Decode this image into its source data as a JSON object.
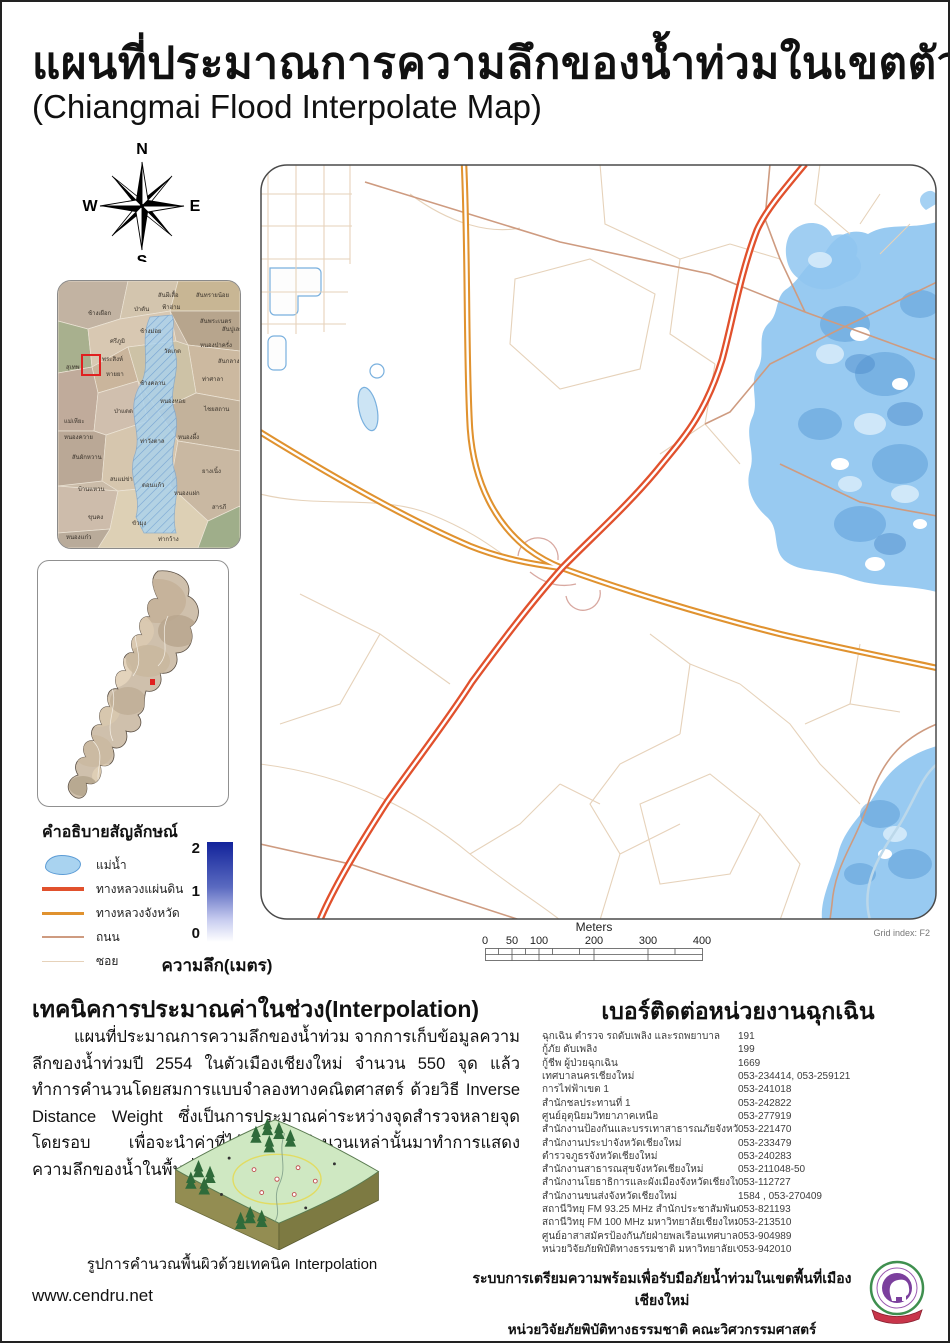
{
  "poster": {
    "title_th": "แผนที่ประมาณการความลึกของน้ำท่วมในเขตตัวเมืองเชียงใหม่",
    "title_en": "(Chiangmai Flood Interpolate Map)"
  },
  "colors": {
    "national": "#E1512D",
    "provincial": "#E0922F",
    "road": "#CE9B80",
    "alley": "#E6D2BA",
    "river_fill": "#A9D3F0",
    "river_stroke": "#5B9BD5",
    "flood": "#8FC6F0",
    "flood_dark": "#5E9FD8",
    "flood_pale": "#D6EBFA",
    "highlight": "#E02020"
  },
  "compass": {
    "n": "N",
    "s": "S",
    "e": "E",
    "w": "W"
  },
  "legend": {
    "title": "คำอธิบายสัญลักษณ์",
    "items": [
      {
        "label": "แม่น้ำ",
        "swatch": "river"
      },
      {
        "label": "ทางหลวงแผ่นดิน",
        "swatch": "national"
      },
      {
        "label": "ทางหลวงจังหวัด",
        "swatch": "provincial"
      },
      {
        "label": "ถนน",
        "swatch": "road"
      },
      {
        "label": "ซอย",
        "swatch": "alley"
      }
    ],
    "ramp": {
      "ticks": [
        "2",
        "1",
        "0"
      ],
      "caption": "ความลึก(เมตร)"
    }
  },
  "scalebar": {
    "unit_label": "Meters",
    "ticks": [
      "0",
      "50",
      "100",
      "200",
      "300",
      "400"
    ]
  },
  "grid_index": "Grid index: F2",
  "inset_city": {
    "labels": [
      {
        "t": "ช้างเผือก",
        "x": 30,
        "y": 34
      },
      {
        "t": "ป่าตัน",
        "x": 76,
        "y": 30
      },
      {
        "t": "สันผีเสื้อ",
        "x": 100,
        "y": 16
      },
      {
        "t": "ฟ้าฮ่าม",
        "x": 104,
        "y": 28
      },
      {
        "t": "สันทรายน้อย",
        "x": 138,
        "y": 16
      },
      {
        "t": "สันพระเนตร",
        "x": 142,
        "y": 42
      },
      {
        "t": "สันปูเลย",
        "x": 164,
        "y": 50
      },
      {
        "t": "ช้างม่อย",
        "x": 82,
        "y": 52
      },
      {
        "t": "ศรีภูมิ",
        "x": 52,
        "y": 62
      },
      {
        "t": "หนองป่าครั่ง",
        "x": 142,
        "y": 66
      },
      {
        "t": "วัดเกต",
        "x": 106,
        "y": 72
      },
      {
        "t": "พระสิงห์",
        "x": 44,
        "y": 80
      },
      {
        "t": "สุเทพ",
        "x": 8,
        "y": 88
      },
      {
        "t": "สันกลาง",
        "x": 160,
        "y": 82
      },
      {
        "t": "หายยา",
        "x": 48,
        "y": 95
      },
      {
        "t": "ช้างคลาน",
        "x": 82,
        "y": 104
      },
      {
        "t": "ท่าศาลา",
        "x": 144,
        "y": 100
      },
      {
        "t": "หนองหอย",
        "x": 102,
        "y": 122
      },
      {
        "t": "ไชยสถาน",
        "x": 146,
        "y": 130
      },
      {
        "t": "ป่าแดด",
        "x": 56,
        "y": 132
      },
      {
        "t": "แม่เหียะ",
        "x": 6,
        "y": 142
      },
      {
        "t": "หนองควาย",
        "x": 6,
        "y": 158
      },
      {
        "t": "สันผักหวาน",
        "x": 14,
        "y": 178
      },
      {
        "t": "ท่าวังตาล",
        "x": 82,
        "y": 162
      },
      {
        "t": "หนองผึ้ง",
        "x": 120,
        "y": 158
      },
      {
        "t": "บ้านแหวน",
        "x": 20,
        "y": 210
      },
      {
        "t": "สบแม่ข่า",
        "x": 52,
        "y": 200
      },
      {
        "t": "ดอนแก้ว",
        "x": 84,
        "y": 206
      },
      {
        "t": "หนองแฝก",
        "x": 116,
        "y": 214
      },
      {
        "t": "ยางเนิ้ง",
        "x": 144,
        "y": 192
      },
      {
        "t": "สารภี",
        "x": 154,
        "y": 228
      },
      {
        "t": "ขุนคง",
        "x": 30,
        "y": 238
      },
      {
        "t": "ขัวมุง",
        "x": 74,
        "y": 244
      },
      {
        "t": "ท่ากว้าง",
        "x": 100,
        "y": 260
      },
      {
        "t": "หนองแก๋ว",
        "x": 8,
        "y": 258
      }
    ]
  },
  "interpolation": {
    "heading": "เทคนิคการประมาณค่าในช่วง(Interpolation)",
    "body": "แผนที่ประมาณการความลึกของน้ำท่วม จากการเก็บข้อมูลความลึกของน้ำท่วมปี 2554 ในตัวเมืองเชียงใหม่ จำนวน 550 จุด แล้วทำการคำนวนโดยสมการแบบจำลองทางคณิตศาสตร์ ด้วยวิธี Inverse Distance Weight ซึ่งเป็นการประมาณค่าระหว่างจุดสำรวจหลายจุดโดยรอบ เพื่อจะนำค่าที่ได้จากการคำนวนเหล่านั้นมาทำการแสดงความลึกของน้ำในพื้นที่เสี่ยงภัยน้ำท่วม",
    "figure_caption": "รูปการคำนวณพื้นผิวด้วยเทคนิค Interpolation"
  },
  "contacts": {
    "heading": "เบอร์ติดต่อหน่วยงานฉุกเฉิน",
    "rows": [
      [
        "ฉุกเฉิน ตำรวจ รถดับเพลิง และรถพยาบาล",
        "191"
      ],
      [
        "กู้ภัย ดับเพลิง",
        "199"
      ],
      [
        "กู้ชีพ ผู้ป่วยฉุกเฉิน",
        "1669"
      ],
      [
        "เทศบาลนครเชียงใหม่",
        "053-234414, 053-259121"
      ],
      [
        "การไฟฟ้าเขต 1",
        "053-241018"
      ],
      [
        "สำนักชลประทานที่ 1",
        "053-242822"
      ],
      [
        "ศูนย์อุตุนิยมวิทยาภาคเหนือ",
        "053-277919"
      ],
      [
        "สำนักงานป้องกันและบรรเทาสาธารณภัยจังหวัดเชียงใหม่",
        "053-221470"
      ],
      [
        "สำนักงานประปาจังหวัดเชียงใหม่",
        "053-233479"
      ],
      [
        "ตำรวจภูธรจังหวัดเชียงใหม่",
        "053-240283"
      ],
      [
        "สำนักงานสาธารณสุขจังหวัดเชียงใหม่",
        "053-211048-50"
      ],
      [
        "สำนักงานโยธาธิการและผังเมืองจังหวัดเชียงใหม่",
        "053-112727"
      ],
      [
        "สำนักงานขนส่งจังหวัดเชียงใหม่",
        "1584 , 053-270409"
      ],
      [
        "สถานีวิทยุ FM 93.25 MHz  สำนักประชาสัมพันธ์ เขต 3",
        "053-821193"
      ],
      [
        "สถานีวิทยุ FM 100 MHz  มหาวิทยาลัยเชียงใหม่",
        "053-213510"
      ],
      [
        "ศูนย์อาสาสมัครป้องกันภัยฝ่ายพลเรือนเทศบาลนครเชียงใหม่",
        "053-904989"
      ],
      [
        "หน่วยวิจัยภัยพิบัติทางธรรมชาติ มหาวิทยาลัยเชียงใหม่",
        "053-942010"
      ]
    ]
  },
  "footer": {
    "website": "www.cendru.net",
    "line1": "ระบบการเตรียมความพร้อมเพื่อรับมือภัยน้ำท่วมในเขตพื้นที่เมืองเชียงใหม่",
    "line2": "หน่วยวิจัยภัยพิบัติทางธรรมชาติ คณะวิศวกรรมศาสตร์ มหาวิทยาลัยเชียงใหม่"
  }
}
